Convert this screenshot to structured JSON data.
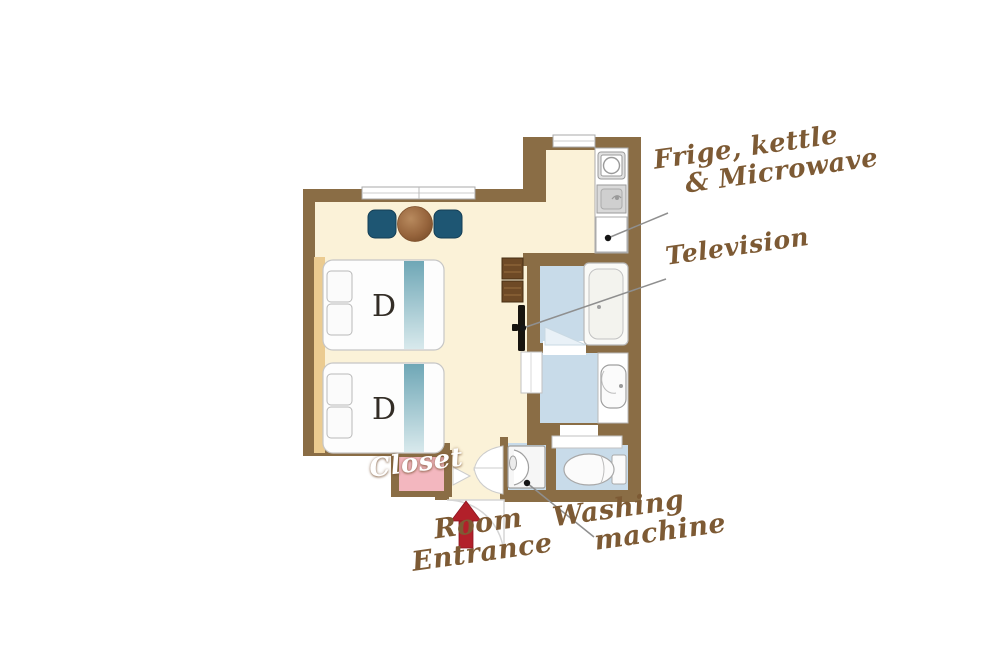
{
  "diagram": {
    "type": "hotel-room-floor-plan",
    "beds": [
      {
        "label": "D"
      },
      {
        "label": "D"
      }
    ],
    "annotations": {
      "fridge": {
        "line1": "Frige, kettle",
        "line2": "& Microwave"
      },
      "television": {
        "text": "Television"
      },
      "closet": {
        "text": "Closet"
      },
      "entrance": {
        "line1": "Room",
        "line2": "Entrance"
      },
      "washing": {
        "line1": "Washing",
        "line2": "machine"
      }
    },
    "rooms": [
      "bedroom-living",
      "kitchenette",
      "bathroom",
      "washroom",
      "toilet",
      "washing-machine-closet",
      "closet",
      "entrance"
    ],
    "palette": {
      "wall_brown": "#8a6d45",
      "floor_cream": "#fbf2d8",
      "wet_floor_blue": "#c8dbe9",
      "closet_pink": "#f3b7bf",
      "chair_blue": "#1e5673",
      "table_brown": "#96643c",
      "bed_stripe_teal": "#74aab8",
      "headboard_tan": "#ebcb90",
      "entrance_arrow_red": "#b2202a",
      "annotation_brown": "#7d5a34",
      "shelf_brown": "#6e4a26",
      "tv_black": "#17140f"
    }
  }
}
